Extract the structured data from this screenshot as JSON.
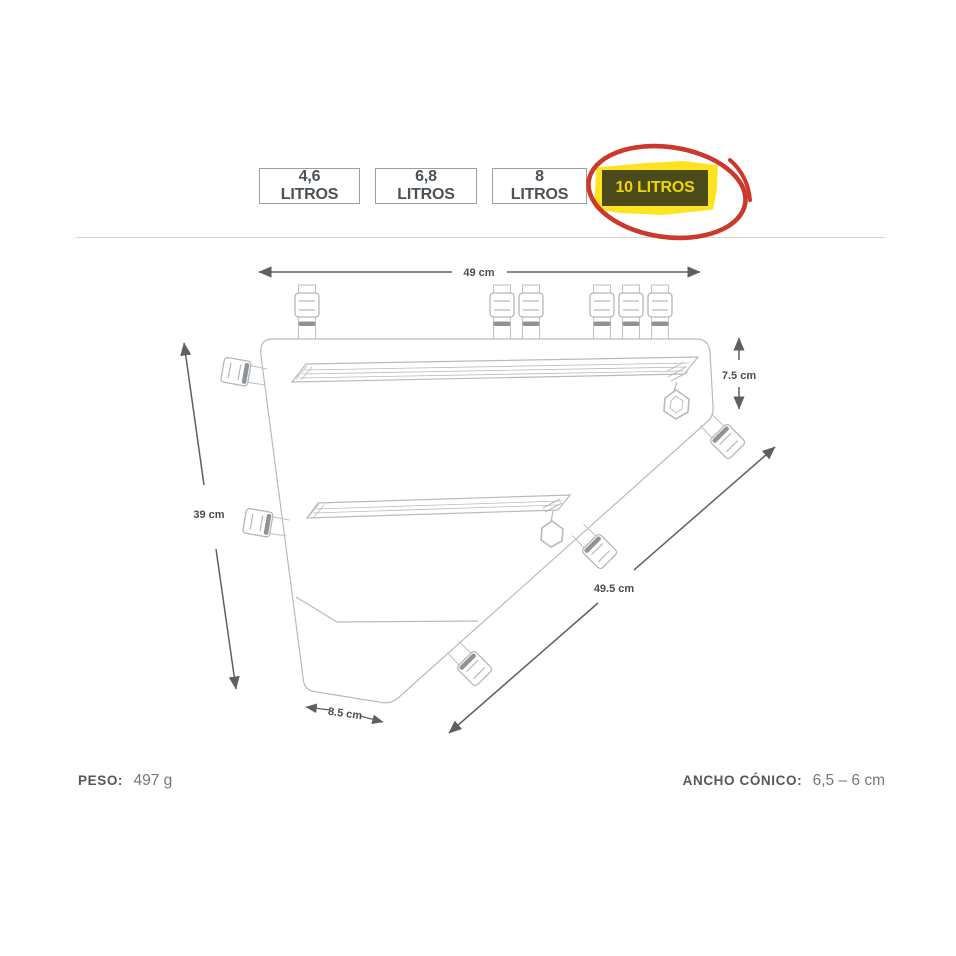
{
  "size_selector": {
    "options": [
      {
        "label": "4,6 LITROS"
      },
      {
        "label": "6,8 LITROS"
      },
      {
        "label": "8 LITROS"
      },
      {
        "label": "10 LITROS"
      }
    ],
    "selected_index": 3,
    "selected_bg": "#4a4a1a",
    "selected_text_color": "#f1d600",
    "highlight_color": "#ffe31f",
    "circle_color": "#cc382b"
  },
  "diagram": {
    "dimensions": {
      "top_width": "49 cm",
      "right_depth": "7.5 cm",
      "left_height": "39 cm",
      "diagonal_length": "49.5 cm",
      "bottom_width": "8.5 cm"
    },
    "line_color": "#b7bbbd",
    "dimension_color": "#5c6064"
  },
  "specs": {
    "weight": {
      "label": "PESO:",
      "value": "497 g"
    },
    "taper": {
      "label": "ANCHO CÓNICO:",
      "value": "6,5 – 6 cm"
    }
  }
}
